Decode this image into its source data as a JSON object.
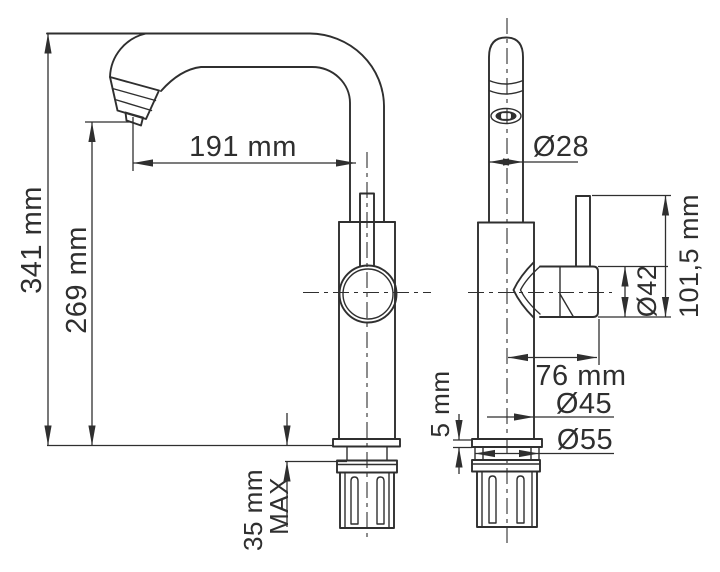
{
  "drawing": {
    "subject": "faucet technical drawing",
    "views": {
      "left": "side view",
      "right": "front view"
    }
  },
  "labels": {
    "total_height": "341 mm",
    "spout_height": "269 mm",
    "spout_reach": "191 mm",
    "deck_thickness": "35 mm",
    "deck_thickness_suffix": "MAX",
    "spout_pipe_diameter": "Ø28",
    "handle_assembly_height": "101,5 mm",
    "handle_diameter": "Ø42",
    "handle_projection": "76 mm",
    "body_diameter": "Ø45",
    "base_flange_diameter": "Ø55",
    "base_flange_height": "5 mm"
  },
  "colors": {
    "line": "#2f2f2f",
    "background": "#ffffff"
  }
}
